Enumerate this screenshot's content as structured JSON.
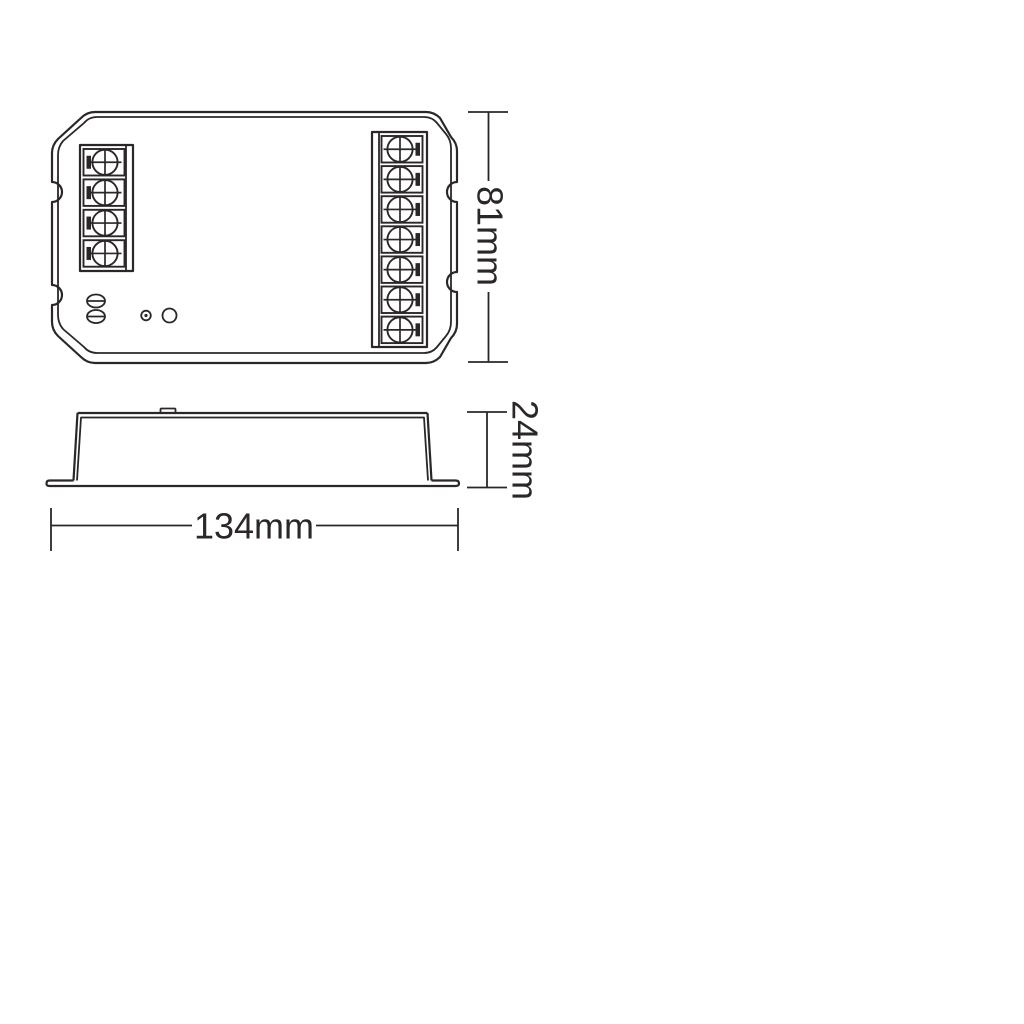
{
  "drawing": {
    "background": "#ffffff",
    "line_color": "#2b2728",
    "views": {
      "top_view": {
        "left_terminal": {
          "screw_count": 4
        },
        "right_terminal": {
          "screw_count": 7
        },
        "slotted_screw_count": 2,
        "has_led_indicator": true,
        "has_button": true
      },
      "side_view": {
        "has_mounting_flanges": true,
        "has_top_tab": true
      }
    },
    "dimensions": {
      "height": {
        "label": "81mm"
      },
      "depth": {
        "label": "24mm"
      },
      "width": {
        "label": "134mm"
      }
    }
  }
}
